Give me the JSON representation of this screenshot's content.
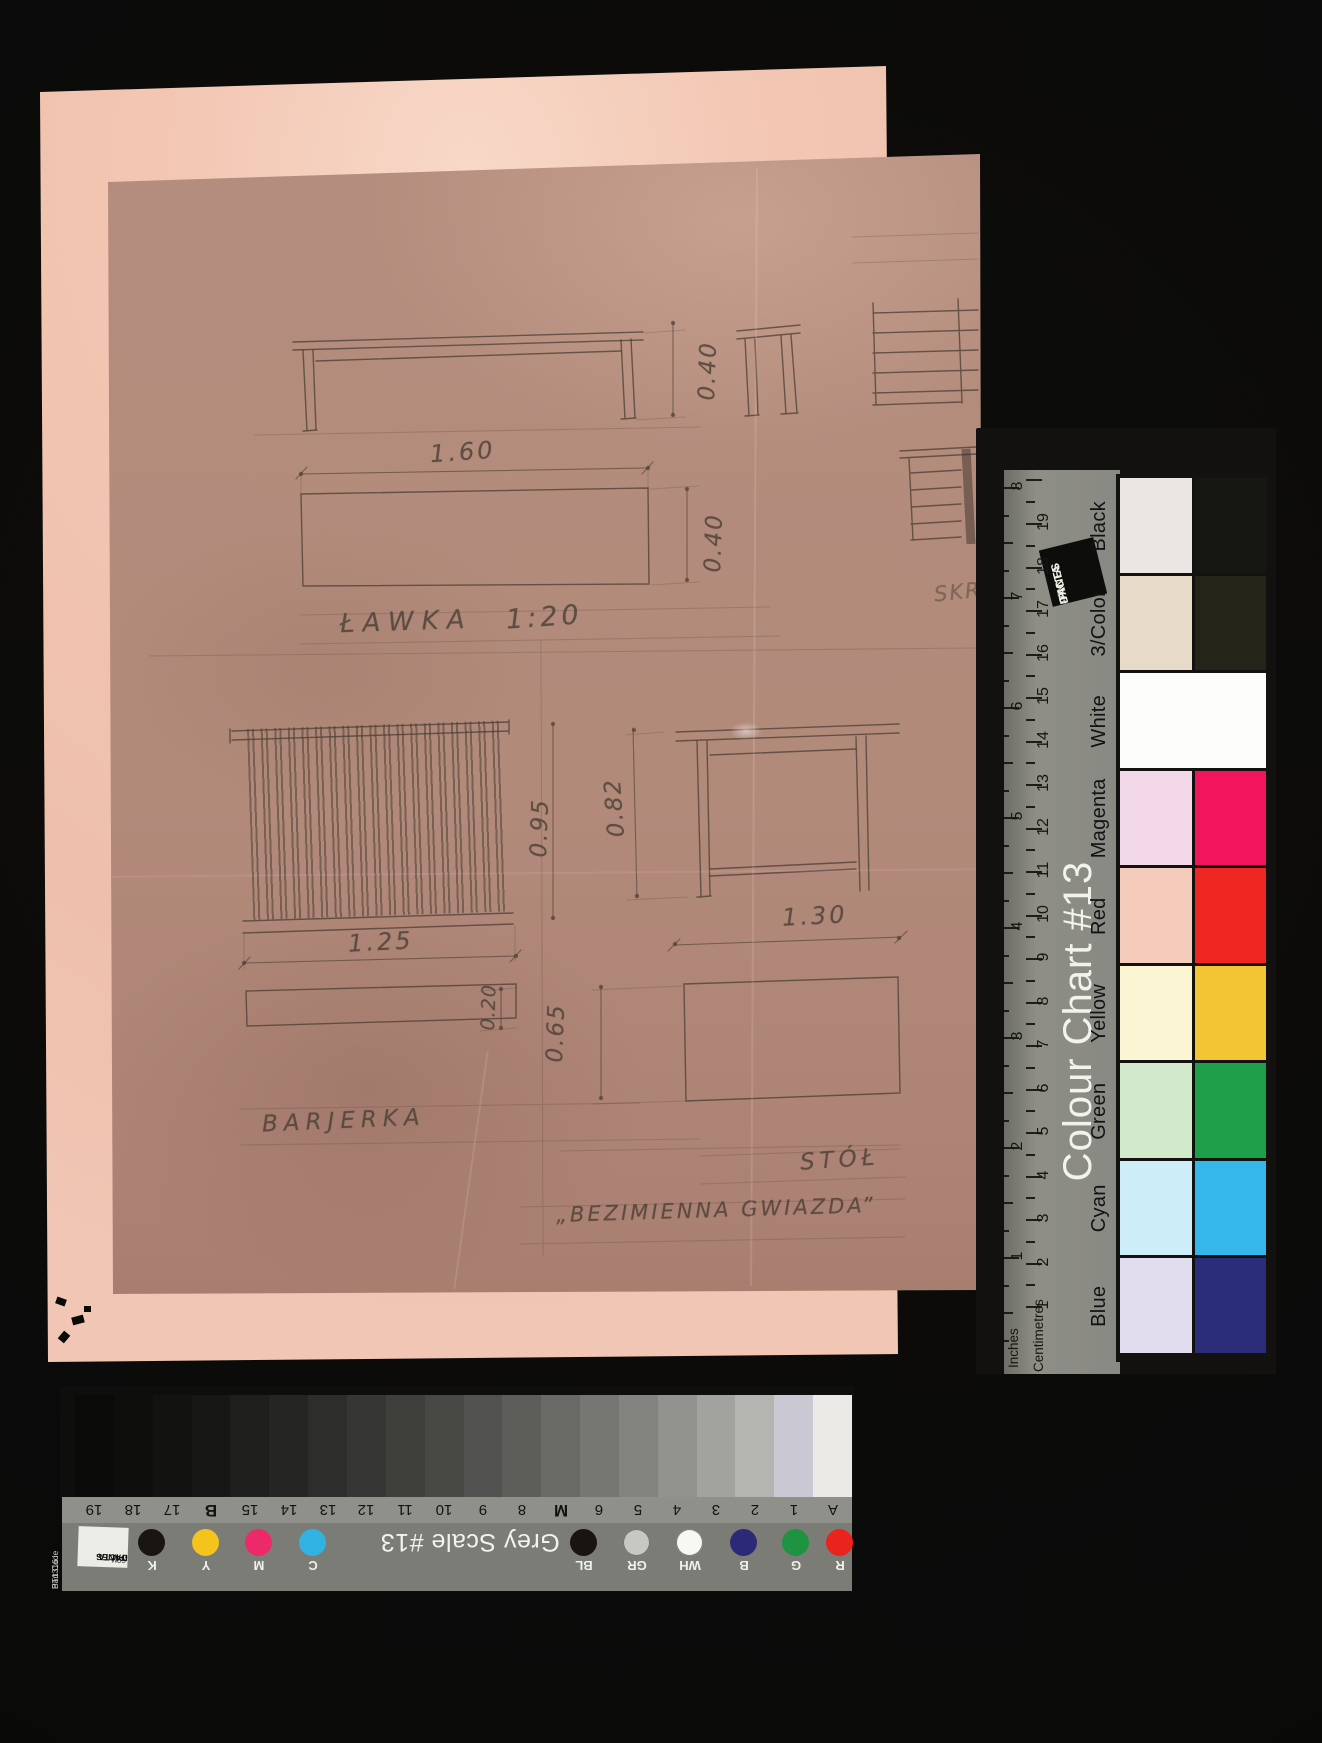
{
  "sketch": {
    "labels": {
      "bench": "ŁAWKA",
      "scale": "1:20",
      "railing": "BARJERKA",
      "table": "STÓŁ",
      "play_title": "„BEZIMIENNA GWIAZDA”",
      "partial_right": "SKR"
    },
    "dimensions": {
      "bench_length": "1.60",
      "bench_height": "0.40",
      "bench_depth": "0.40",
      "railing_length": "1.25",
      "railing_height": "0.95",
      "railing_depth": "0.20",
      "table_height": "0.82",
      "table_length": "1.30",
      "table_depth": "0.65"
    }
  },
  "colour_chart": {
    "title": "Colour Chart #13",
    "brand_lines": [
      "DANES",
      "-PICTA",
      ".COM"
    ],
    "ruler": {
      "inches_label": "Inches",
      "centimetres_label": "Centimetres",
      "inch_numbers": [
        "8",
        "7",
        "6",
        "5",
        "4",
        "3",
        "2",
        "1"
      ],
      "cm_numbers": [
        "19",
        "18",
        "17",
        "16",
        "15",
        "14",
        "13",
        "12",
        "11",
        "10",
        "9",
        "8",
        "7",
        "6",
        "5",
        "4",
        "3",
        "2",
        "1"
      ]
    },
    "rows": [
      {
        "label": "Black",
        "pale": "#eae6e3",
        "vivid": "#171712",
        "span": false
      },
      {
        "label": "3/Color",
        "pale": "#e8dac8",
        "vivid": "#242418",
        "span": false
      },
      {
        "label": "White",
        "pale": "#fdfdfb",
        "vivid": "#fdfdfb",
        "span": true
      },
      {
        "label": "Magenta",
        "pale": "#f2d8e9",
        "vivid": "#f2145c",
        "span": false
      },
      {
        "label": "Red",
        "pale": "#f5cbbb",
        "vivid": "#ef2621",
        "span": false
      },
      {
        "label": "Yellow",
        "pale": "#fbf5d3",
        "vivid": "#f3c434",
        "span": false
      },
      {
        "label": "Green",
        "pale": "#d3e9cc",
        "vivid": "#1ea04a",
        "span": false
      },
      {
        "label": "Cyan",
        "pale": "#cdeef8",
        "vivid": "#36b7ea",
        "span": false
      },
      {
        "label": "Blue",
        "pale": "#e1dcee",
        "vivid": "#2b2d7b",
        "span": false
      }
    ]
  },
  "grey_scale": {
    "title": "Grey Scale #13",
    "brand_lines": [
      "DANES",
      "-PICTA",
      ".COM"
    ],
    "part_code_lines": [
      "Part Code",
      "BT1316"
    ],
    "patches": [
      {
        "label": "19",
        "color": "#0a0a09"
      },
      {
        "label": "18",
        "color": "#0e0e0d"
      },
      {
        "label": "17",
        "color": "#121211"
      },
      {
        "label": "B",
        "color": "#171715"
      },
      {
        "label": "15",
        "color": "#1e1e1c"
      },
      {
        "label": "14",
        "color": "#252523"
      },
      {
        "label": "13",
        "color": "#2d2d2b"
      },
      {
        "label": "12",
        "color": "#363634"
      },
      {
        "label": "11",
        "color": "#3f3f3c"
      },
      {
        "label": "10",
        "color": "#484845"
      },
      {
        "label": "9",
        "color": "#525250"
      },
      {
        "label": "8",
        "color": "#5d5d5a"
      },
      {
        "label": "M",
        "color": "#696965"
      },
      {
        "label": "6",
        "color": "#767672"
      },
      {
        "label": "5",
        "color": "#83837f"
      },
      {
        "label": "4",
        "color": "#92928e"
      },
      {
        "label": "3",
        "color": "#a2a29e"
      },
      {
        "label": "2",
        "color": "#b4b4b1"
      },
      {
        "label": "1",
        "color": "#c9c8d3"
      },
      {
        "label": "A",
        "color": "#ebeae7"
      }
    ],
    "dots_left": [
      {
        "label": "K",
        "color": "#181512"
      },
      {
        "label": "Y",
        "color": "#f4c41c"
      },
      {
        "label": "M",
        "color": "#ec2a6a"
      },
      {
        "label": "C",
        "color": "#30b2e2"
      }
    ],
    "dots_mid": [
      {
        "label": "BL",
        "color": "#171411"
      },
      {
        "label": "GR",
        "color": "#c8c8c3"
      },
      {
        "label": "WH",
        "color": "#f7f7f3"
      }
    ],
    "dots_right": [
      {
        "label": "B",
        "color": "#2c2a78"
      },
      {
        "label": "G",
        "color": "#1e9342"
      },
      {
        "label": "R",
        "color": "#ea231e"
      }
    ]
  }
}
